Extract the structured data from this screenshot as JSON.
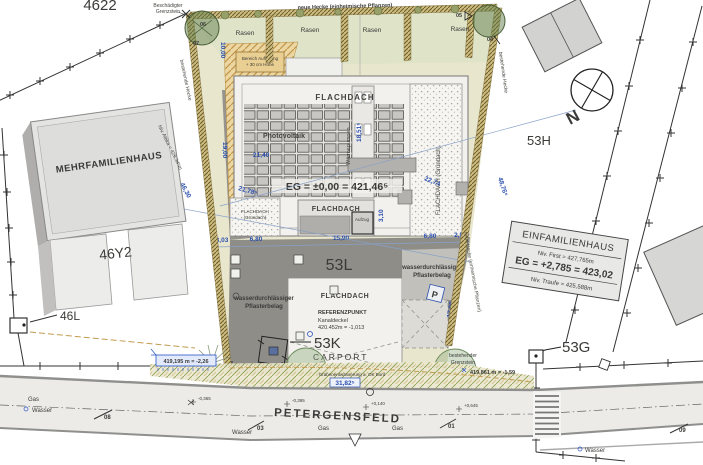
{
  "parcels": {
    "a": "4622",
    "h": "53H",
    "l": "53L",
    "k": "53K",
    "g": "53G",
    "y": "46Y2",
    "l46": "46L"
  },
  "buildings": {
    "mfh": "MEHRFAMILIENHAUS",
    "efh_title": "EINFAMILIENHAUS",
    "efh_first": "Niv. First = 427,765m",
    "efh_eg": "EG = +2,785 = 423,02",
    "efh_traufe": "Niv. Traufe = 425,588m"
  },
  "roof": {
    "flachdach": "FLACHDACH",
    "gruendach": "FLACHDACH (Gründach)",
    "gruendach_l1": "FLACHDACH",
    "gruendach_l2": "(Gründach)",
    "photovoltaik": "Photovoltaik",
    "waermepumpen": "Wärmepumpen",
    "aufzug": "Aufzug",
    "eg": "EG = ±0,00 = 421,46⁵",
    "attika": "Niv. Attika = 429,34⁵m"
  },
  "site": {
    "rasen": "Rasen",
    "neue_hecke": "neue Hecke (einheimische Pflanzen)",
    "bestehende_hecke": "bestehende Hecke",
    "auffuellung_1": "Bereich Auffüllung",
    "auffuellung_2": "+ 30 cm Höhe",
    "pflaster_1": "wasserdurchlässiger",
    "pflaster_2": "Pflasterbelag",
    "besch_1": "Beschädigter",
    "besch_2": "Grenzstein",
    "best_1": "bestehender",
    "best_2": "Grenzstein",
    "graben": "Grabenentwässerung a. OK Bord",
    "carport": "CARPORT"
  },
  "referenz": {
    "title": "REFERENZPUNKT",
    "kanaldeckel": "Kanaldeckel",
    "value": "420.452m = -1,013"
  },
  "benchmarks": {
    "left": "419,195 m = -2,26",
    "right": "419,861 m = -1,59"
  },
  "street": {
    "name": "PETERGENSFELD",
    "gas": "Gas",
    "wasser": "Wasser",
    "elev_1": "-0,365",
    "elev_2": "-0,395",
    "elev_3": "+0,140",
    "elev_4": "+0,645",
    "m08": "08",
    "m03": "03",
    "m01": "01",
    "m09": "09"
  },
  "dims": {
    "d10": "10,00",
    "d19": "19,00",
    "d4630": "46,30",
    "d4876": "48,76⁵",
    "d2140": "21,40",
    "d2178": "21,78⁵",
    "d1851": "18,51⁵",
    "d2274": "22,74",
    "d303": "3,03",
    "d680": "6,80",
    "d1590": "15,90",
    "d296": "2,96⁵",
    "d310": "3,10",
    "d1708": "17,08",
    "d3182": "31,82⁵"
  },
  "trees": {
    "t04": "04",
    "t05": "05",
    "t06": "06",
    "t07": "07"
  },
  "compass": {
    "n": "N"
  },
  "colors": {
    "dim_blue": "#2a4fae",
    "grenz_green": "#3f7d3f",
    "gas_yellow": "#a8923c",
    "wasser_blue": "#2a55c8"
  }
}
